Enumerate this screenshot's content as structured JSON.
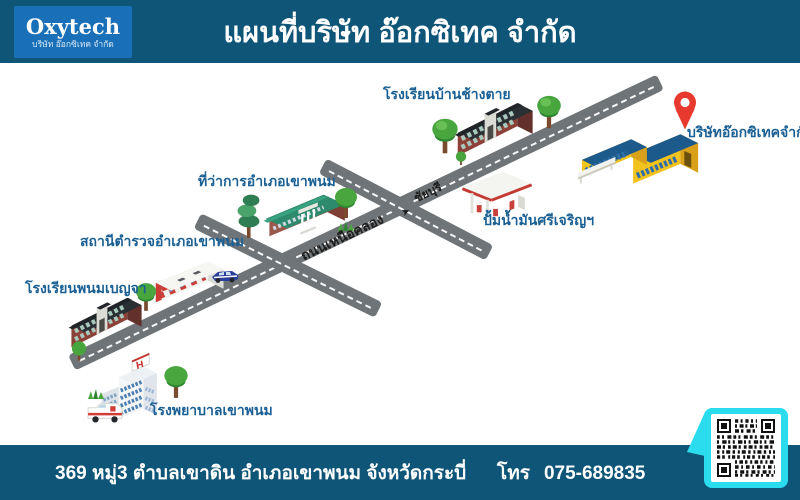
{
  "header": {
    "logo_title": "Oxytech",
    "logo_subtitle": "บริษัท อ๊อกซิเทค จำกัด",
    "title": "แผนที่บริษัท อ๊อกซิเทค จำกัด"
  },
  "map": {
    "labels": {
      "school_changtai": "โรงเรียนบ้านช้างตาย",
      "company": "บริษัทอ๊อกซิเทคจำกัด",
      "district_office": "ที่ว่าการอำเภอเขาพนม",
      "gas_station": "ปั้มน้ำมันศรีเจริญฯ",
      "police_station": "สถานีตำรวจอำเภอเขาพนม",
      "school_phanombenja": "โรงเรียนพนมเบญจา",
      "hospital": "โรงพยาบาลเขาพนม"
    },
    "roads": {
      "main_road_name": "ถนนเหนือคลอง",
      "direction_name": "ชัยบุรี",
      "direction_arrow": "➤"
    }
  },
  "footer": {
    "address": "369 หมู่3 ตำบลเขาดิน อำเภอเขาพนม จังหวัดกระบี่",
    "phone_label": "โทร",
    "phone_number": "075-689835"
  },
  "colors": {
    "header_bg": "#0e5578",
    "logo_bg": "#1a70b8",
    "label_blue": "#1b6094",
    "road_gray": "#6f7478",
    "pin_red": "#e8392e",
    "qr_cyan": "#2bdcee",
    "company_yellow": "#f2c31f",
    "company_roof_blue": "#1c5a8c"
  }
}
